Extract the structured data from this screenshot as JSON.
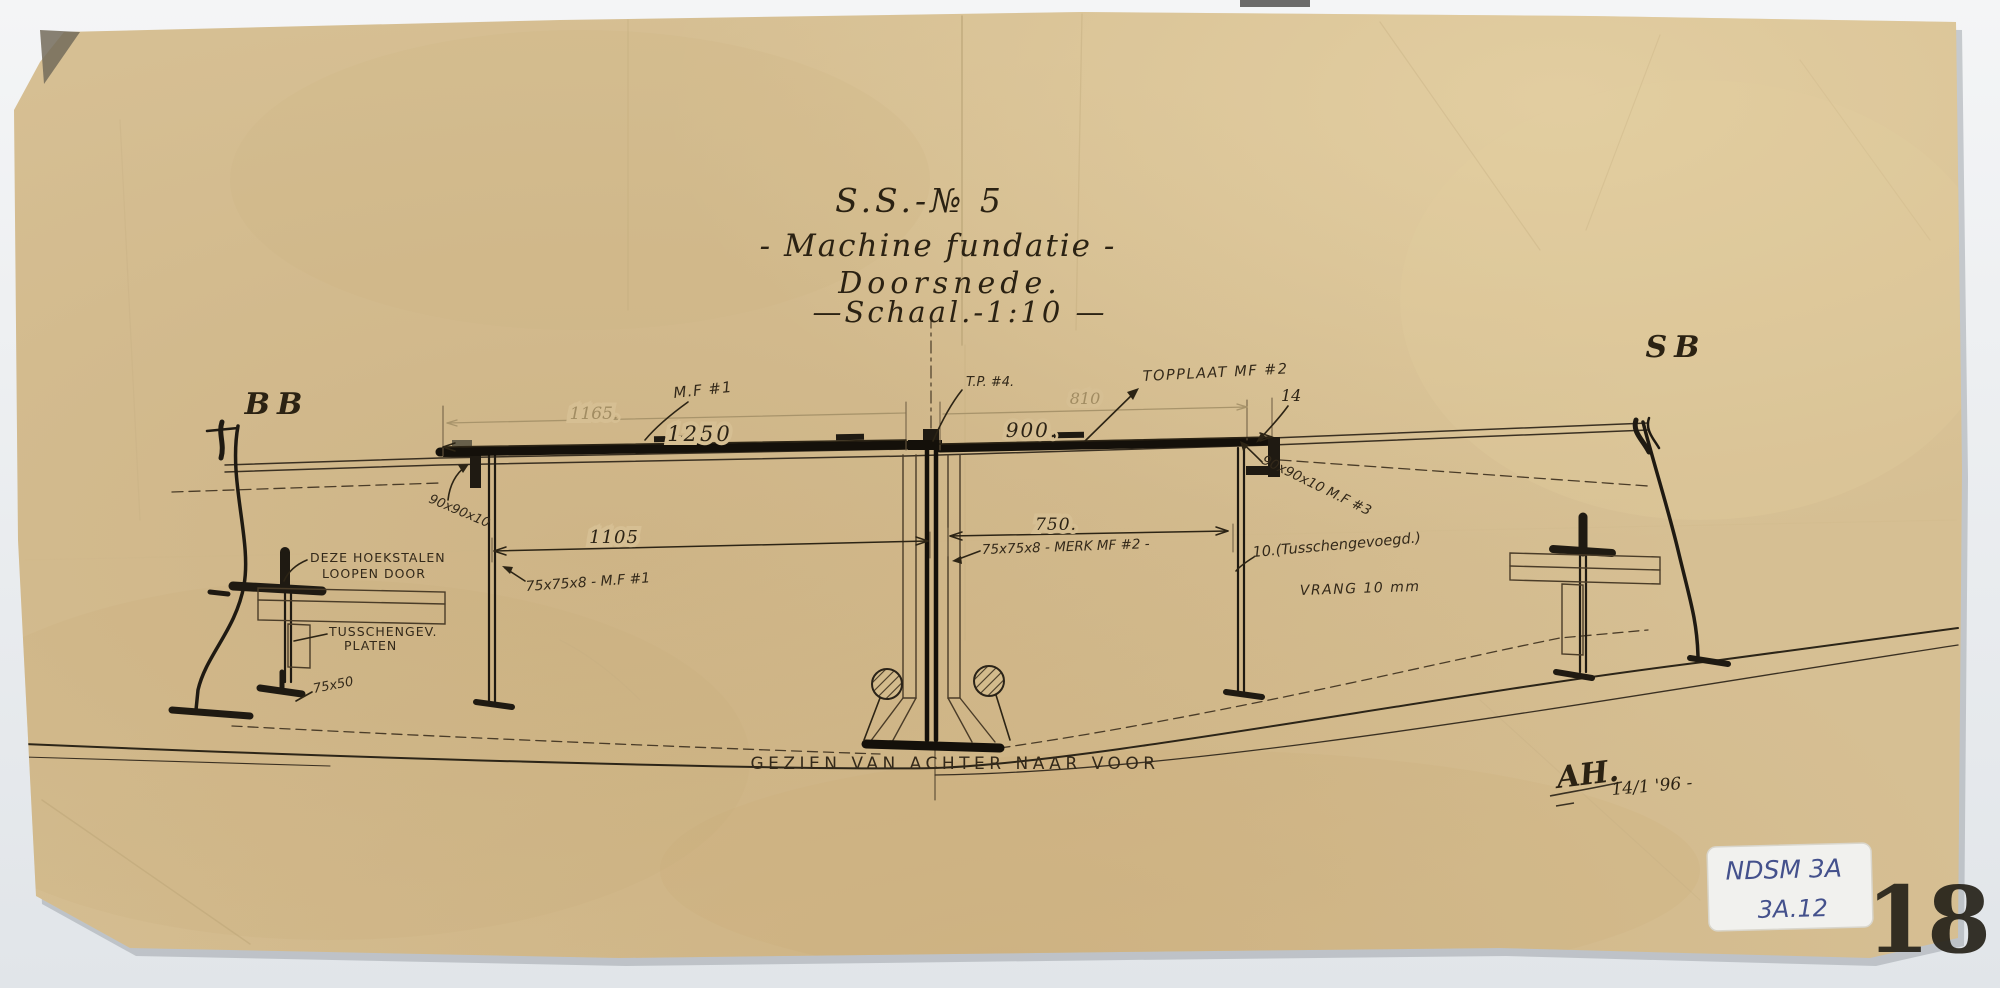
{
  "document": {
    "title": {
      "line1": "S.S.-№ 5",
      "line2": "- Machine fundatie -",
      "line3": "Doorsnede.",
      "line4": "—Schaal.-1:10 —"
    },
    "side_labels": {
      "left": "BB",
      "right": "SB"
    },
    "dimensions": {
      "d1165": "1165.",
      "d1250": "1250",
      "d810": "810",
      "d900": "900.",
      "d14": "14",
      "d1105": "1105",
      "d750": "750."
    },
    "labels": {
      "mf1_top": "M.F #1",
      "tp4": "T.P. #4.",
      "topplaat": "TOPPLAAT MF #2",
      "angle_left": "90x90x10",
      "angle_right": "90x90x10 M.F #3",
      "web_left": "75x75x8 - M.F #1",
      "web_right": "75x75x8 - MERK MF #2 -",
      "packing": "10.(Tusschengevoegd.)",
      "vrang": "VRANG 10 mm",
      "hoekstalen_line1": "DEZE HOEKSTALEN",
      "hoekstalen_line2": "LOOPEN DOOR",
      "tusschengev_line1": "TUSSCHENGEV.",
      "tusschengev_line2": "PLATEN",
      "size_75x50": "75x50",
      "caption": "GEZIEN VAN ACHTER NAAR VOOR"
    },
    "signature": {
      "initials": "AH.",
      "date": "14/1 '96 -"
    },
    "archive": {
      "sticker_line1": "NDSM 3A",
      "sticker_line2": "3A.12",
      "stamp": "18"
    }
  },
  "colors": {
    "paper": "#d6bf93",
    "ink": "#292218",
    "pencil": "#a18c62",
    "sticker_ink": "#44518c",
    "background": "#eef0f2"
  }
}
